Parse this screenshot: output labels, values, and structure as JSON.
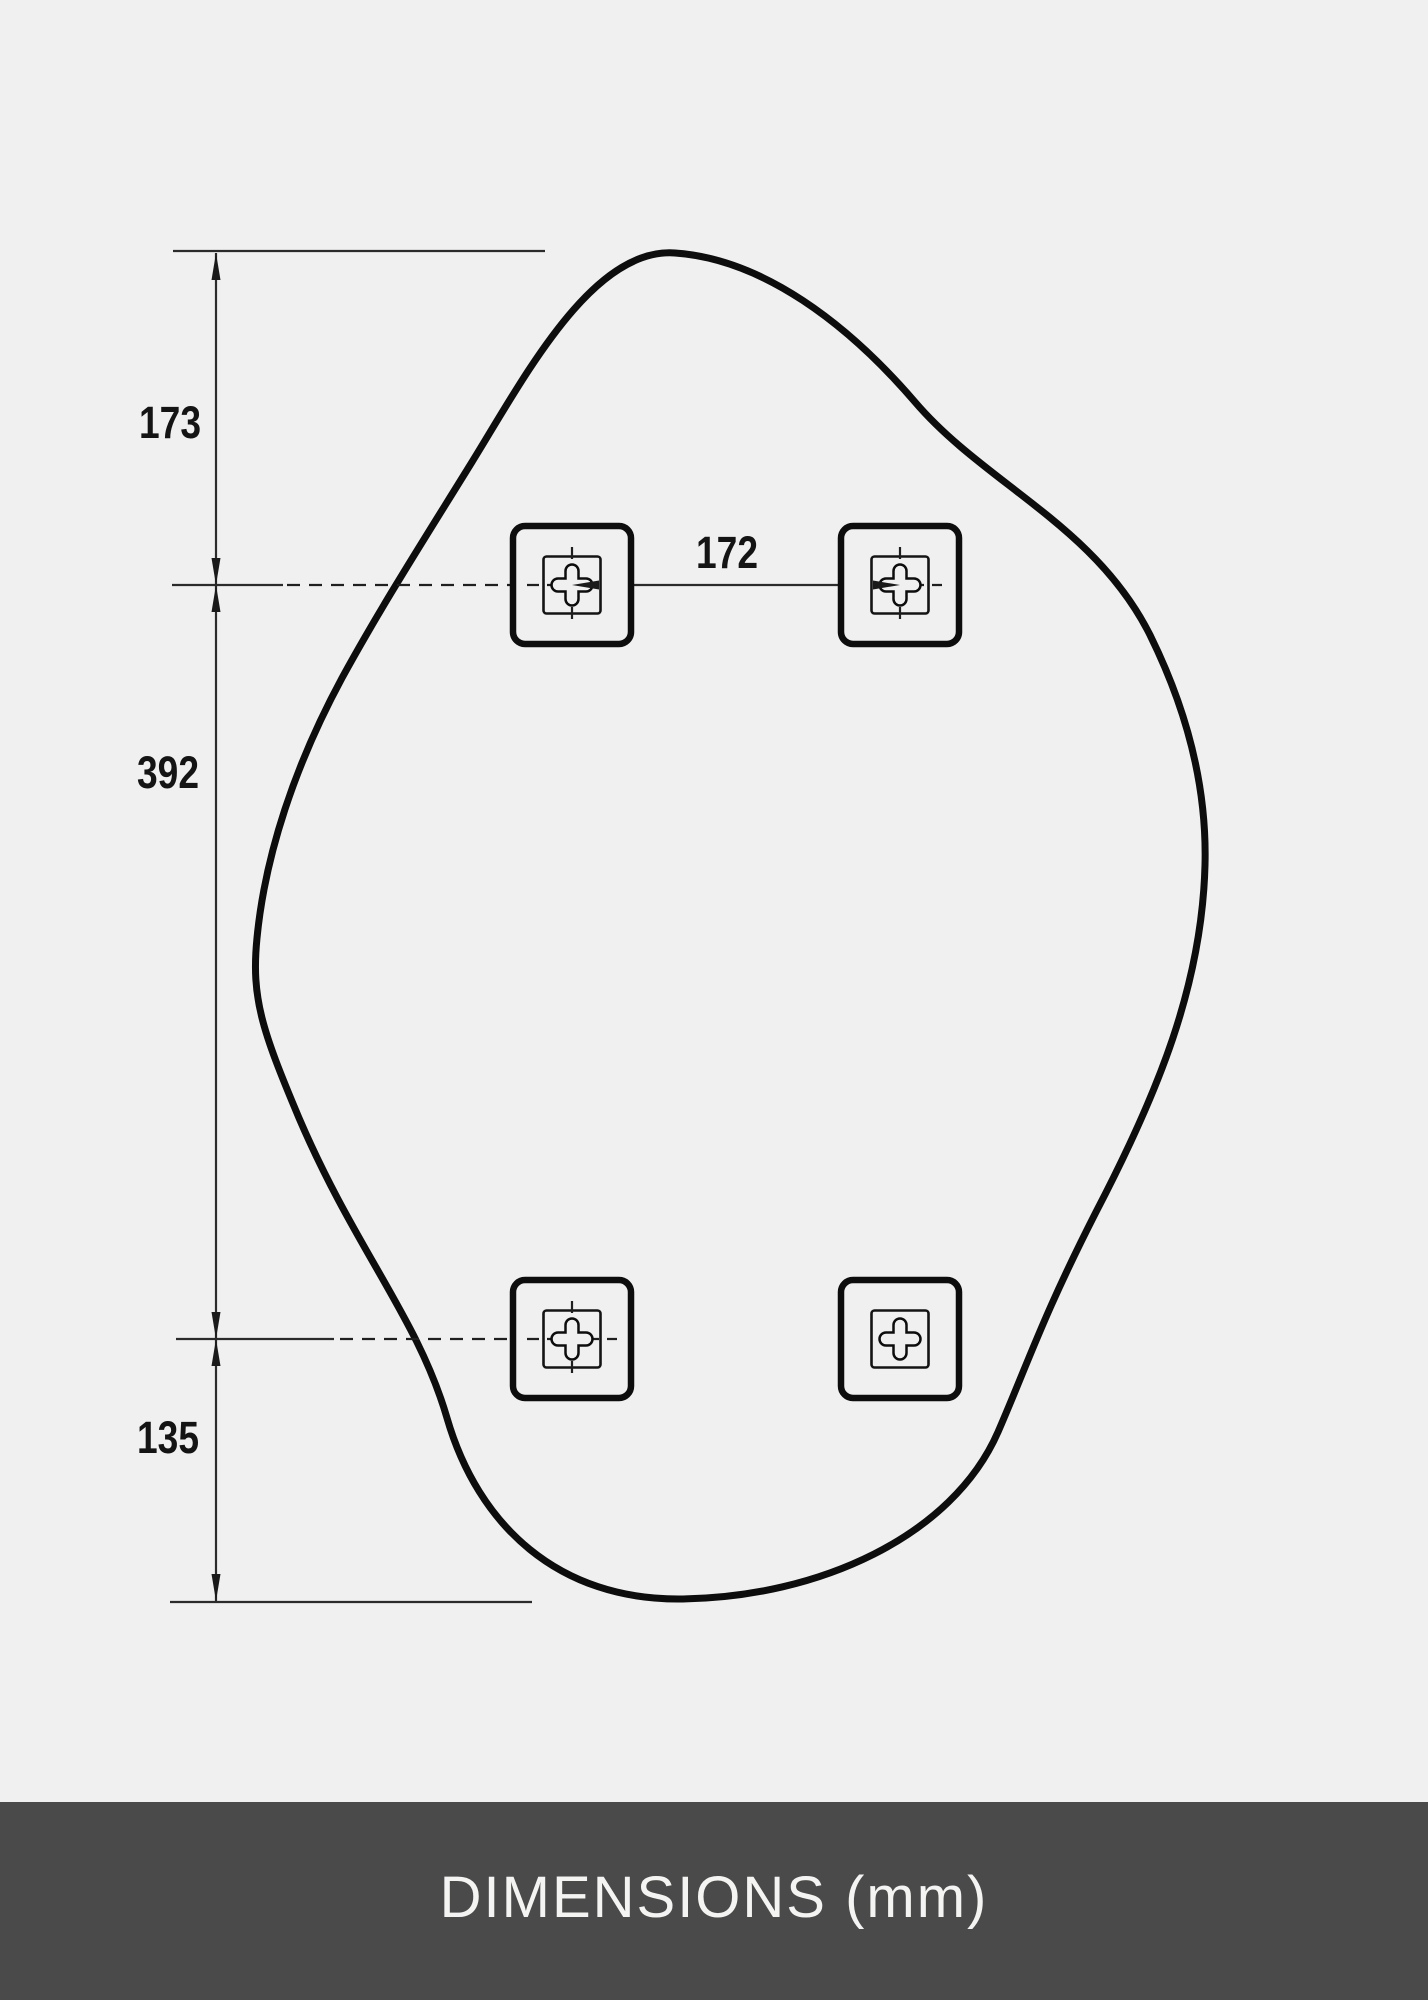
{
  "diagram": {
    "type": "technical-dimension-drawing",
    "subject": "organic pebble-shaped mirror outline with four square mounting brackets",
    "units": "mm",
    "dimensions": {
      "top_edge_to_upper_holes": "173",
      "upper_holes_to_lower_holes": "392",
      "lower_holes_to_bottom_edge": "135",
      "hole_spacing_horizontal": "172"
    }
  },
  "footer": {
    "label": "DIMENSIONS (mm)"
  },
  "colors": {
    "background": "#f0f0f1",
    "outline": "#0d0d0d",
    "thin_line": "#2b2b2b",
    "footer_bar": "#4a4a4a",
    "footer_text": "#f4f4f3"
  }
}
